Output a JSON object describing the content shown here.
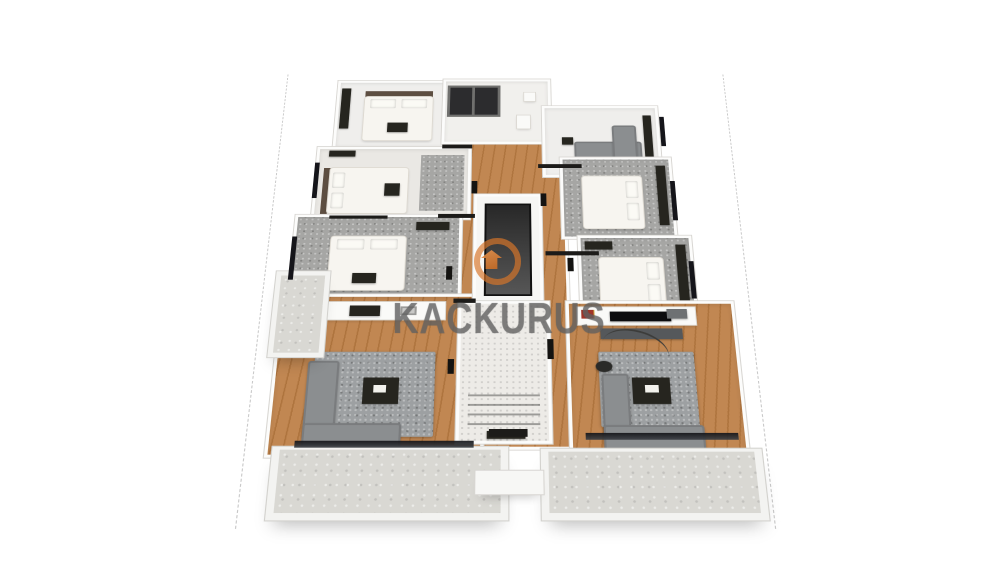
{
  "image": {
    "type": "3d-floor-plan-render",
    "background": "#ffffff"
  },
  "watermark": {
    "text": "KACKURUS"
  },
  "palette": {
    "wall": "#fcfcfb",
    "wood": "#c18752",
    "wood_dark": "#ae743e",
    "carpet": "#a6a6a4",
    "rug": "#9da0a2",
    "sofa": "#8b8e90",
    "balcony": "#d9d8d3",
    "terrazzo": "#edebe7",
    "bed": "#f7f5f0",
    "dark_furniture": "#26251f",
    "wm_orange": "rgba(216,118,42,0.8)",
    "wm_text": "rgba(104,104,104,0.6)"
  },
  "scene": {
    "rooms": [
      "bedroom-top-left",
      "bathroom-top",
      "lounge-top-right",
      "bedroom-left-2",
      "bedroom-left-3",
      "bedroom-right-1",
      "bedroom-right-2",
      "living-kitchen-left",
      "living-room-right",
      "elevator-core",
      "staircase",
      "balcony-bottom-left",
      "balcony-bottom-right",
      "balcony-side-left"
    ]
  }
}
